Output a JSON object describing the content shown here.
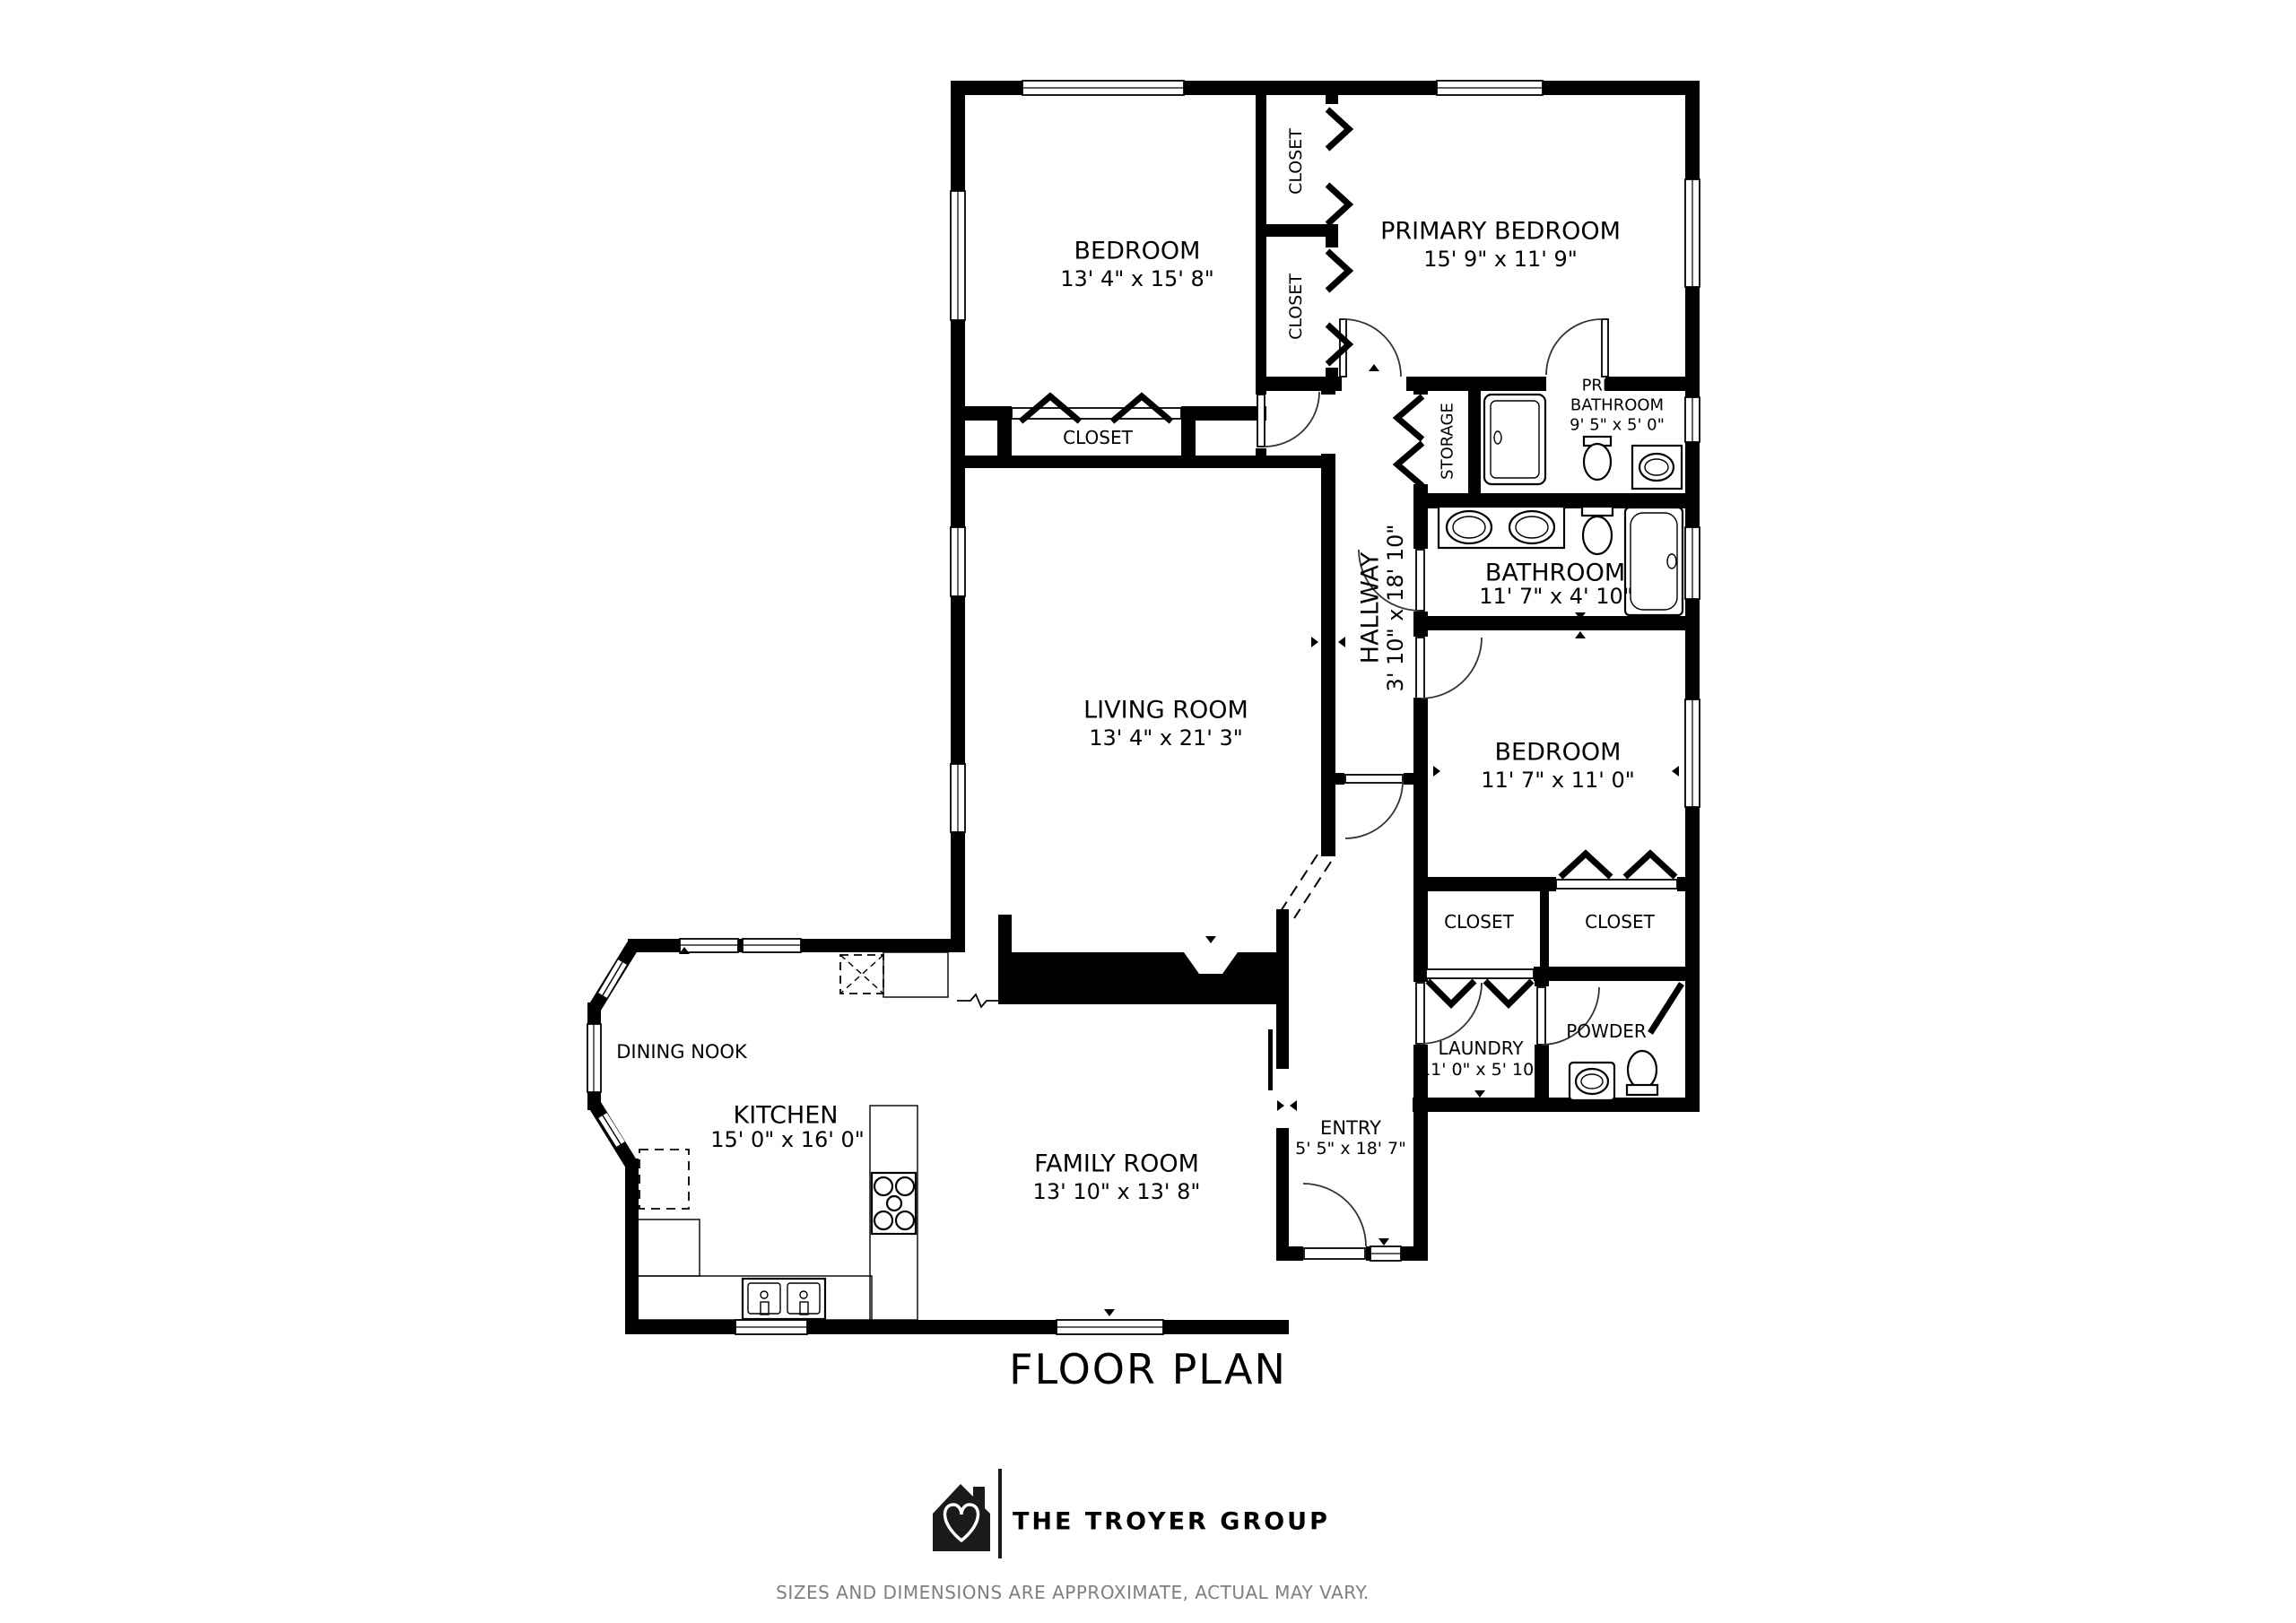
{
  "page": {
    "title": "FLOOR PLAN"
  },
  "branding": {
    "name": "THE TROYER GROUP",
    "logo_icon": "house-heart-icon"
  },
  "disclaimer": "SIZES AND DIMENSIONS ARE APPROXIMATE, ACTUAL MAY VARY.",
  "rooms": {
    "bedroom_top": {
      "name": "BEDROOM",
      "dims": "13' 4\" x 15' 8\""
    },
    "primary_bedroom": {
      "name": "PRIMARY BEDROOM",
      "dims": "15' 9\" x 11' 9\""
    },
    "closet_top_a": {
      "name": "CLOSET"
    },
    "closet_top_b": {
      "name": "CLOSET"
    },
    "closet_bedroom_top": {
      "name": "CLOSET"
    },
    "storage": {
      "name": "STORAGE"
    },
    "primary_bathroom": {
      "name_line1": "PRIMARY",
      "name_line2": "BATHROOM",
      "dims": "9' 5\" x 5' 0\""
    },
    "bathroom": {
      "name": "BATHROOM",
      "dims": "11' 7\" x 4' 10\""
    },
    "hallway": {
      "name": "HALLWAY",
      "dims": "3' 10\" x 18' 10\""
    },
    "living_room": {
      "name": "LIVING ROOM",
      "dims": "13' 4\" x 21' 3\""
    },
    "bedroom_right": {
      "name": "BEDROOM",
      "dims": "11' 7\" x 11' 0\""
    },
    "closet_right_a": {
      "name": "CLOSET"
    },
    "closet_right_b": {
      "name": "CLOSET"
    },
    "laundry": {
      "name": "LAUNDRY",
      "dims": "11' 0\" x 5' 10\""
    },
    "powder": {
      "name": "POWDER"
    },
    "dining_nook": {
      "name": "DINING NOOK"
    },
    "kitchen": {
      "name": "KITCHEN",
      "dims": "15' 0\" x 16' 0\""
    },
    "family_room": {
      "name": "FAMILY ROOM",
      "dims": "13' 10\" x 13' 8\""
    },
    "entry": {
      "name": "ENTRY",
      "dims": "5' 5\" x 18' 7\""
    }
  }
}
